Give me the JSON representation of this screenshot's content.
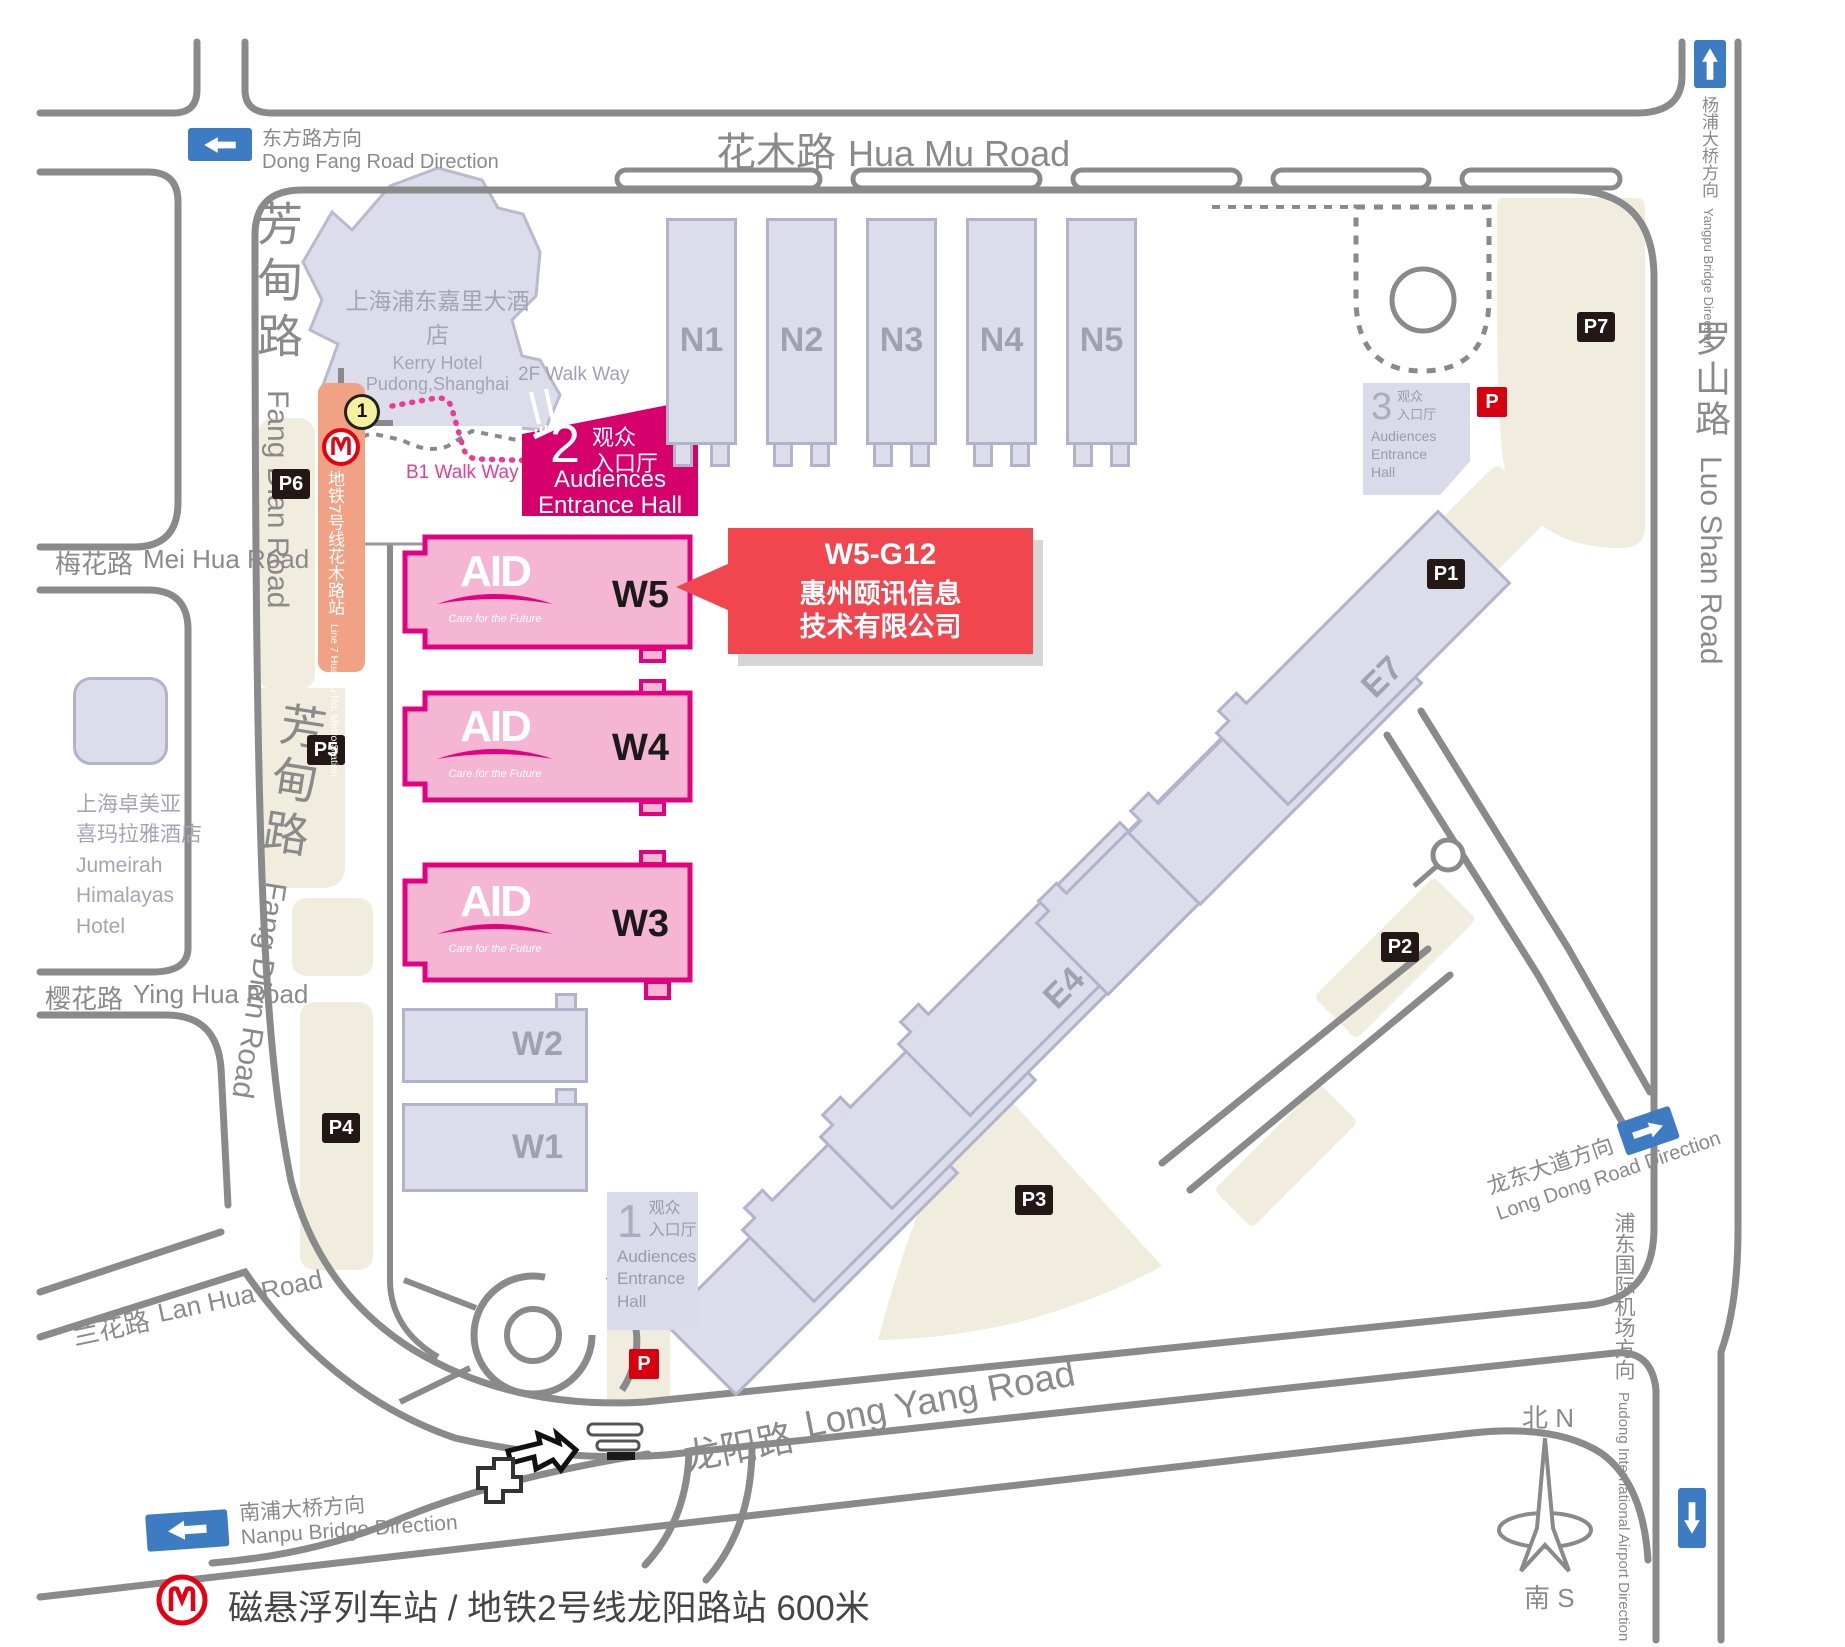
{
  "colors": {
    "accent_magenta": "#E2017E",
    "entrance_magenta": "#D5006C",
    "hall_pink": "#F5B6D3",
    "hall_gray": "#DCDDEB",
    "parking_beige": "#F1EDDE",
    "road_gray": "#8A8A8A",
    "callout_red": "#F2464F",
    "metro_orange": "#F2A284",
    "metro_red": "#E60012",
    "sign_blue": "#3D7CC2",
    "parking_black": "#231815",
    "parking_red": "#D7000F"
  },
  "roads": {
    "hua_mu": {
      "zh": "花木路",
      "en": "Hua Mu Road"
    },
    "fang_dian": {
      "zh": "芳甸路",
      "en": "Fang Dian Road"
    },
    "mei_hua": {
      "zh": "梅花路",
      "en": "Mei Hua Road"
    },
    "ying_hua": {
      "zh": "樱花路",
      "en": "Ying Hua Road"
    },
    "lan_hua": {
      "zh": "兰花路",
      "en": "Lan Hua Road"
    },
    "long_yang": {
      "zh": "龙阳路",
      "en": "Long Yang Road"
    },
    "luo_shan": {
      "zh": "罗山路",
      "en": "Luo Shan Road"
    }
  },
  "directions": {
    "dong_fang": {
      "zh": "东方路方向",
      "en": "Dong Fang Road Direction"
    },
    "yangpu": {
      "zh": "杨浦大桥方向",
      "en": "Yangpu Bridge Direction"
    },
    "nanpu": {
      "zh": "南浦大桥方向",
      "en": "Nanpu Bridge Direction"
    },
    "long_dong": {
      "zh": "龙东大道方向",
      "en": "Long Dong Road Direction"
    },
    "pudong_airport": {
      "zh": "浦东国际机场方向",
      "en": "Pudong International Airport Direction"
    }
  },
  "halls": {
    "north": [
      "N1",
      "N2",
      "N3",
      "N4",
      "N5"
    ],
    "west": [
      "W5",
      "W4",
      "W3",
      "W2",
      "W1"
    ],
    "east": [
      "E1",
      "E2",
      "E3",
      "E4",
      "E5",
      "E6",
      "E7"
    ]
  },
  "entrances": [
    {
      "number": "1",
      "zh_line1": "观众",
      "zh_line2": "入口厅",
      "en_line1": "Audiences",
      "en_line2": "Entrance",
      "en_line3": "Hall"
    },
    {
      "number": "2",
      "zh_line1": "观众",
      "zh_line2": "入口厅",
      "en_line1": "Audiences",
      "en_line2": "Entrance Hall"
    },
    {
      "number": "3",
      "zh_line1": "观众",
      "zh_line2": "入口厅",
      "en_line1": "Audiences",
      "en_line2": "Entrance",
      "en_line3": "Hall"
    }
  ],
  "parking": {
    "lots": [
      "P1",
      "P2",
      "P3",
      "P4",
      "P5",
      "P6",
      "P7"
    ],
    "icon": "P"
  },
  "landmarks": {
    "kerry_hotel": {
      "zh": "上海浦东嘉里大酒店",
      "en": "Kerry Hotel Pudong,Shanghai"
    },
    "jumeirah": {
      "zh1": "上海卓美亚",
      "zh2": "喜玛拉雅酒店",
      "en1": "Jumeirah",
      "en2": "Himalayas",
      "en3": "Hotel"
    },
    "metro_line7": {
      "zh": "地铁7号线花木路站",
      "en": "Line 7 Hua Mu Rd. Metro Station"
    },
    "walkway_2f": "2F Walk Way",
    "walkway_b1": "B1 Walk Way",
    "exit_badge": "1"
  },
  "aid_logo": {
    "text": "AID",
    "tagline": "Care for the Future"
  },
  "callout": {
    "booth": "W5-G12",
    "company_line1": "惠州颐讯信息",
    "company_line2": "技术有限公司"
  },
  "compass": {
    "north": "北 N",
    "south": "南 S"
  },
  "footer": {
    "metro_note": "磁悬浮列车站 / 地铁2号线龙阳路站  600米"
  }
}
